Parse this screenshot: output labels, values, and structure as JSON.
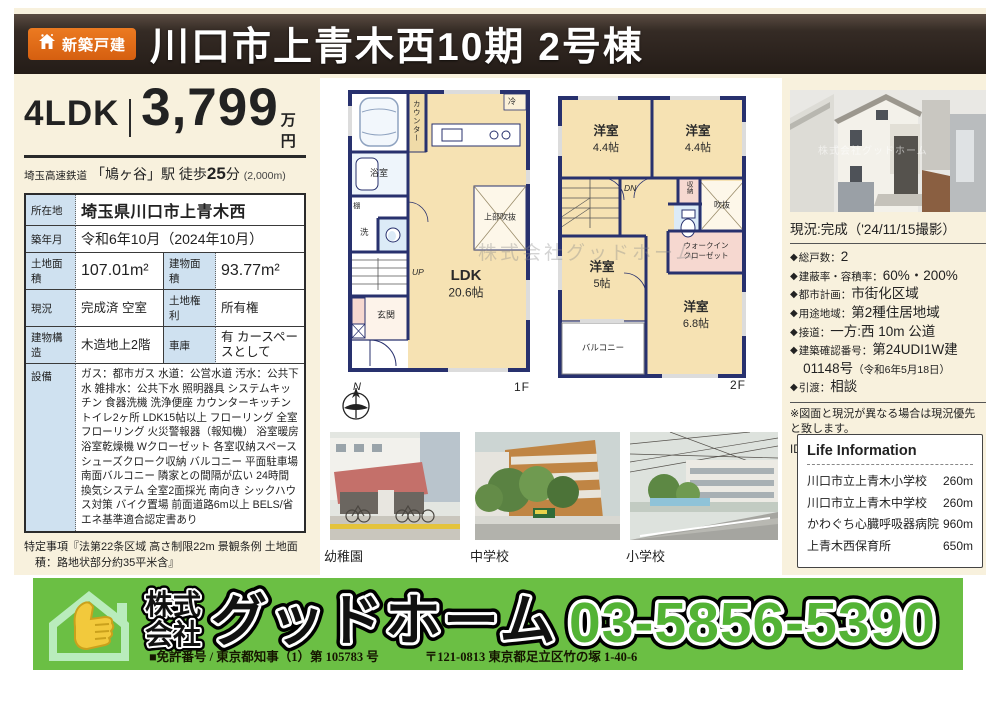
{
  "header": {
    "badge": "新築戸建",
    "title": "川口市上青木西10期 2号棟"
  },
  "price": {
    "layout": "4LDK",
    "amount": "3,799",
    "unit": "万円"
  },
  "access": {
    "line": "埼玉高速鉄道",
    "station": "「鳩ヶ谷」駅 徒歩",
    "minutes": "25",
    "minutes_unit": "分",
    "distance": "(2,000m)"
  },
  "spec_table": {
    "rows": [
      {
        "label": "所在地",
        "value": "埼玉県川口市上青木西"
      },
      {
        "label": "築年月",
        "value": "令和6年10月（2024年10月）"
      },
      {
        "label": "土地面積",
        "value": "107.01m²",
        "label2": "建物面積",
        "value2": "93.77m²"
      },
      {
        "label": "現況",
        "value": "完成済 空室",
        "label2": "土地権利",
        "value2": "所有権"
      },
      {
        "label": "建物構造",
        "value": "木造地上2階",
        "label2": "車庫",
        "value2": "有 カースペースとして"
      },
      {
        "label": "設備",
        "value": "ガス：都市ガス 水道：公営水道 汚水：公共下水 雑排水：公共下水 照明器具 システムキッチン 食器洗機 洗浄便座 カウンターキッチン トイレ2ヶ所 LDK15帖以上 フローリング 全室フローリング 火災警報器（報知機） 浴室暖房 浴室乾燥機 Wクローゼット 各室収納スペース シューズクローク収納 バルコニー 平面駐車場 南面バルコニー 隣家との間隔が広い 24時間換気システム 全室2面採光 南向き シックハウス対策 バイク置場 前面道路6m以上 BELS/省エネ基準適合認定書あり"
      }
    ]
  },
  "notes": {
    "tokutei": "特定事項『法第22条区域 高さ制限22m 景観条例 土地面積：路地状部分約35平米含』"
  },
  "floorplan": {
    "watermark": "株式会社グッドホーム",
    "f1": {
      "name": "1F",
      "ldk": "LDK",
      "ldk_size": "20.6帖",
      "bath": "浴室",
      "shelf": "棚",
      "wash": "洗",
      "counter": "カウンター",
      "fridge": "冷",
      "void": "上部吹抜",
      "entrance": "玄関",
      "up": "UP",
      "north": "N"
    },
    "f2": {
      "name": "2F",
      "room1": "洋室",
      "room1_size": "4.4帖",
      "room2": "洋室",
      "room2_size": "4.4帖",
      "room3": "洋室",
      "room3_size": "5帖",
      "room4": "洋室",
      "room4_size": "6.8帖",
      "dn": "DN",
      "storage": "収納",
      "void": "吹抜",
      "wic1": "ウォークイン",
      "wic2": "クローゼット",
      "balcony": "バルコニー"
    }
  },
  "photos": {
    "captions": [
      "幼稚園",
      "中学校",
      "小学校"
    ]
  },
  "property": {
    "bullet": "◆",
    "photo_caption": "現況:完成（'24/11/15撮影）",
    "details": [
      {
        "label": "総戸数：",
        "value": "2"
      },
      {
        "label": "建蔽率・容積率：",
        "value": "60%・200%"
      },
      {
        "label": "都市計画：",
        "value": "市街化区域"
      },
      {
        "label": "用途地域：",
        "value": "第2種住居地域"
      },
      {
        "label": "接道：",
        "value": "一方:西 10m 公道"
      },
      {
        "label": "建築確認番号：",
        "value": "第24UDI1W建01148号",
        "value_sub": "（令和6年5月18日）"
      },
      {
        "label": "引渡：",
        "value": "相談"
      }
    ],
    "note": "※図面と現況が異なる場合は現況優先と致します。",
    "id": "ID:0757579"
  },
  "life_info": {
    "title": "Life Information",
    "items": [
      {
        "name": "川口市立上青木小学校",
        "distance": "260m"
      },
      {
        "name": "川口市立上青木中学校",
        "distance": "260m"
      },
      {
        "name": "かわぐち心臓呼吸器病院",
        "distance": "960m"
      },
      {
        "name": "上青木西保育所",
        "distance": "650m"
      }
    ]
  },
  "footer": {
    "company_prefix_1": "株式",
    "company_prefix_2": "会社",
    "company_name": "グッドホーム",
    "phone": "03-5856-5390",
    "license": "■免許番号 / 東京都知事（1）第 105783 号",
    "address": "〒121-0813 東京都足立区竹の塚 1-40-6"
  },
  "colors": {
    "accent_orange": "#dd6615",
    "banner_green": "#6bbf44",
    "phone_green": "#53b335",
    "wall_navy": "#28316e",
    "room_beige": "#f6e2b3",
    "label_blue": "#cfe1f0"
  }
}
